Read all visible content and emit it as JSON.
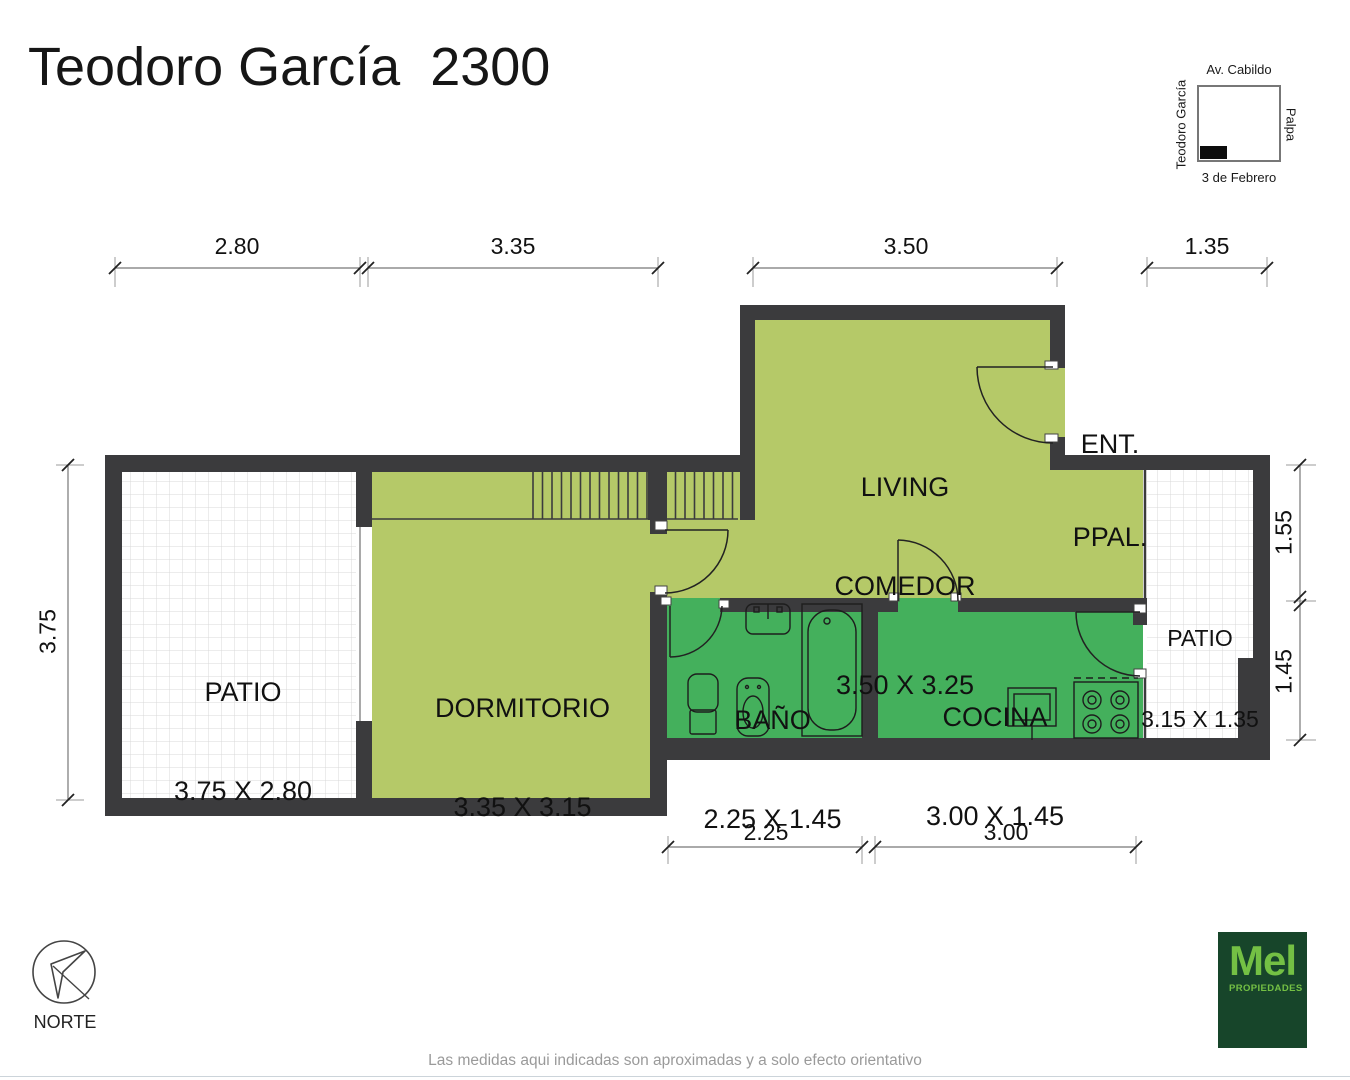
{
  "title": "Teodoro García  2300",
  "minimap": {
    "top": "Av. Cabildo",
    "left": "Teodoro García",
    "right": "Palpa",
    "bottom": "3 de Febrero"
  },
  "rooms": {
    "living": {
      "line1": "LIVING",
      "line2": "COMEDOR",
      "size": "3.50 X 3.25"
    },
    "entrance": {
      "line1": "ENT.",
      "line2": "PPAL."
    },
    "patio_right": {
      "name": "PATIO",
      "size": "3.15 X 1.35"
    },
    "patio_left": {
      "name": "PATIO",
      "size": "3.75 X 2.80"
    },
    "dormitorio": {
      "name": "DORMITORIO",
      "size": "3.35 X 3.15"
    },
    "bano": {
      "name": "BAÑO",
      "size": "2.25 X 1.45"
    },
    "cocina": {
      "name": "COCINA",
      "size": "3.00 X 1.45"
    }
  },
  "dimensions": {
    "top": [
      "2.80",
      "3.35",
      "3.50",
      "1.35"
    ],
    "bottom": [
      "2.25",
      "3.00"
    ],
    "left": [
      "3.75"
    ],
    "right": [
      "1.55",
      "1.45"
    ]
  },
  "compass_label": "NORTE",
  "logo": {
    "brand": "Mel",
    "subtitle": "PROPIEDADES"
  },
  "footer": "Las medidas aqui indicadas son aproximadas y a solo efecto orientativo",
  "colors": {
    "wall": "#3b3b3d",
    "room_light": "#b5c968",
    "room_dark": "#44b05c",
    "grid_line": "#d9d9d9",
    "logo_bg": "#17452a",
    "logo_text": "#74c044",
    "dim_line": "#777777",
    "footer_text": "#9a9a9a"
  }
}
